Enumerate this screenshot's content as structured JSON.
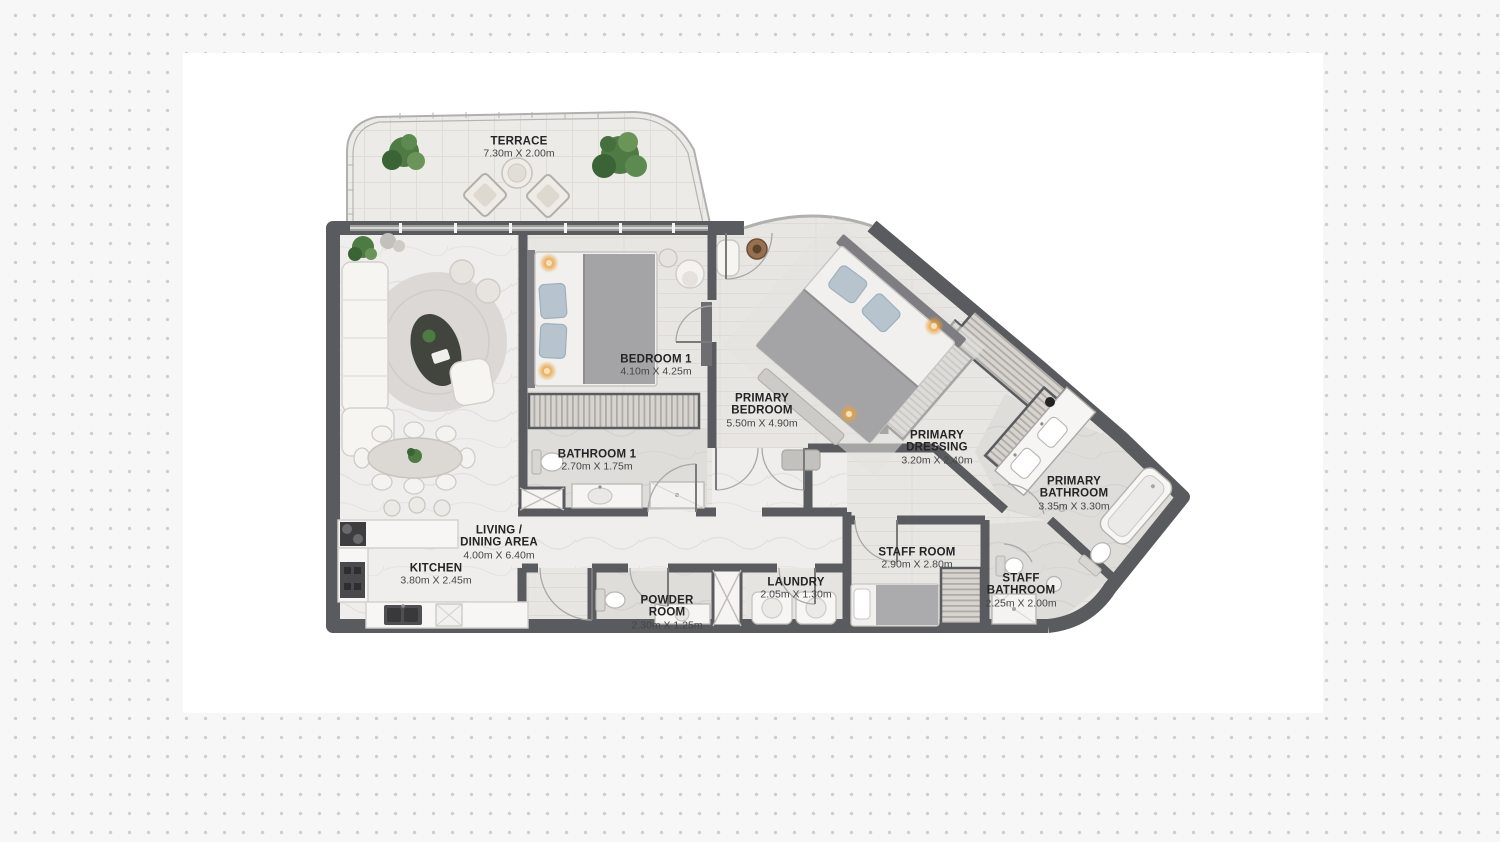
{
  "page": {
    "background_color": "#f7f7f8",
    "dot_color": "#cfcfd1",
    "card_color": "#ffffff"
  },
  "floorplan": {
    "wall_color": "#5a5b5e",
    "floor_color": "#e9e7e3",
    "bath_floor_color": "#dfddda",
    "plant_color": "#4e7a44",
    "ceiling_light_color": "#e8a13c",
    "pillow_color": "#b7c4ce",
    "rooms": [
      {
        "id": "terrace",
        "name": "TERRACE",
        "dims": "7.30m X 2.00m"
      },
      {
        "id": "bedroom-1",
        "name": "BEDROOM 1",
        "dims": "4.10m X 4.25m"
      },
      {
        "id": "primary-bedroom",
        "name": "PRIMARY\nBEDROOM",
        "dims": "5.50m X 4.90m"
      },
      {
        "id": "bathroom-1",
        "name": "BATHROOM 1",
        "dims": "2.70m X 1.75m"
      },
      {
        "id": "primary-dressing",
        "name": "PRIMARY\nDRESSING",
        "dims": "3.20m X 2.40m"
      },
      {
        "id": "primary-bathroom",
        "name": "PRIMARY\nBATHROOM",
        "dims": "3.35m X 3.30m"
      },
      {
        "id": "living-dining",
        "name": "LIVING /\nDINING AREA",
        "dims": "4.00m X 6.40m"
      },
      {
        "id": "kitchen",
        "name": "KITCHEN",
        "dims": "3.80m X 2.45m"
      },
      {
        "id": "staff-room",
        "name": "STAFF ROOM",
        "dims": "2.90m X 2.80m"
      },
      {
        "id": "laundry",
        "name": "LAUNDRY",
        "dims": "2.05m X 1.30m"
      },
      {
        "id": "powder-room",
        "name": "POWDER\nROOM",
        "dims": "2.30m X 1.25m"
      },
      {
        "id": "staff-bathroom",
        "name": "STAFF\nBATHROOM",
        "dims": "2.25m X 2.00m"
      }
    ]
  }
}
